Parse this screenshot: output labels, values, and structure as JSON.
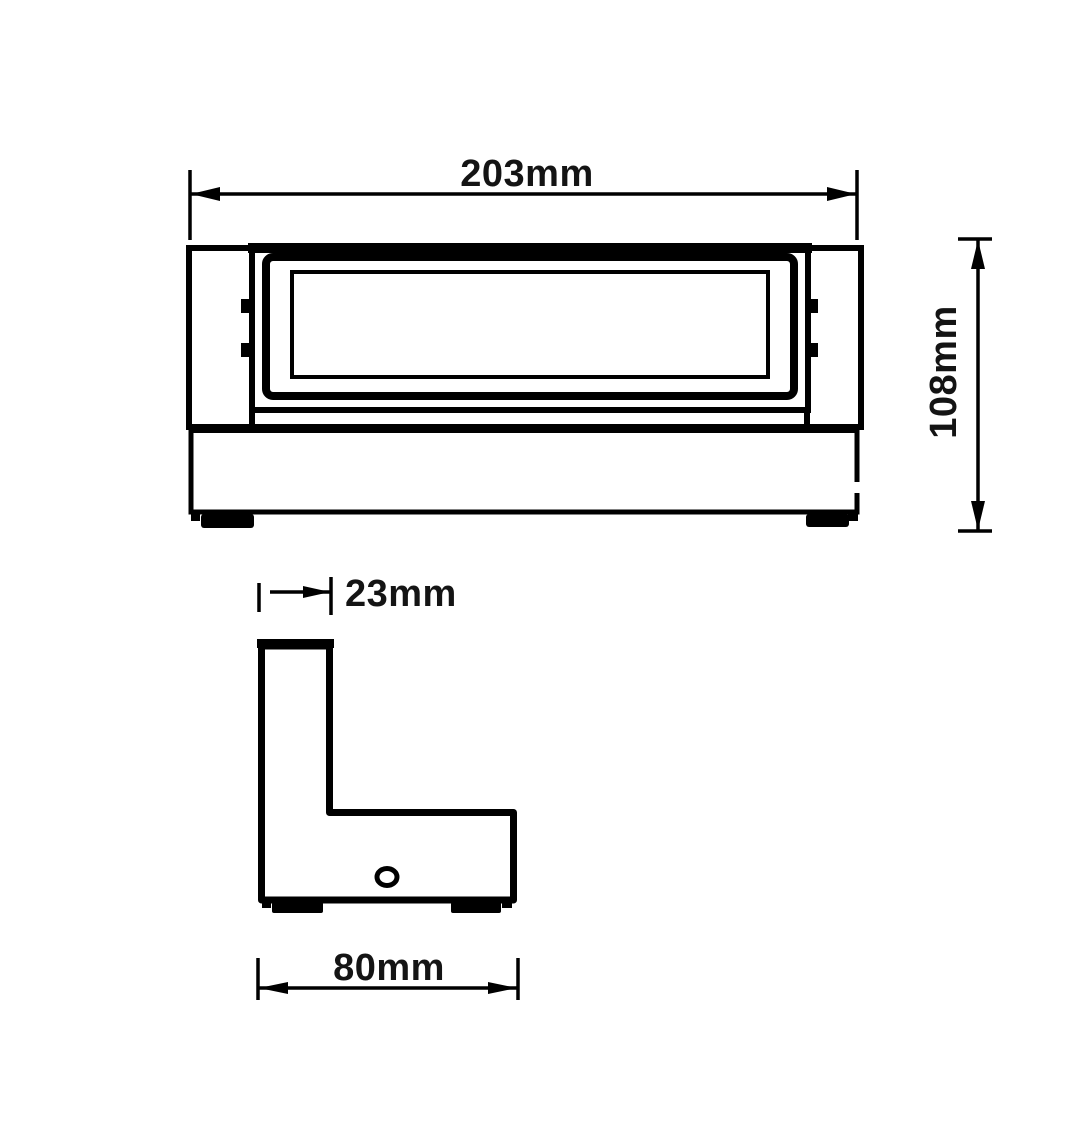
{
  "canvas": {
    "background": "#ffffff",
    "line_color": "#000000",
    "text_color": "#141414"
  },
  "dimensions": {
    "overall_width": {
      "label": "203mm",
      "value": 203,
      "unit": "mm"
    },
    "overall_height": {
      "label": "108mm",
      "value": 108,
      "unit": "mm"
    },
    "top_depth": {
      "label": "23mm",
      "value": 23,
      "unit": "mm"
    },
    "base_depth": {
      "label": "80mm",
      "value": 80,
      "unit": "mm"
    }
  }
}
